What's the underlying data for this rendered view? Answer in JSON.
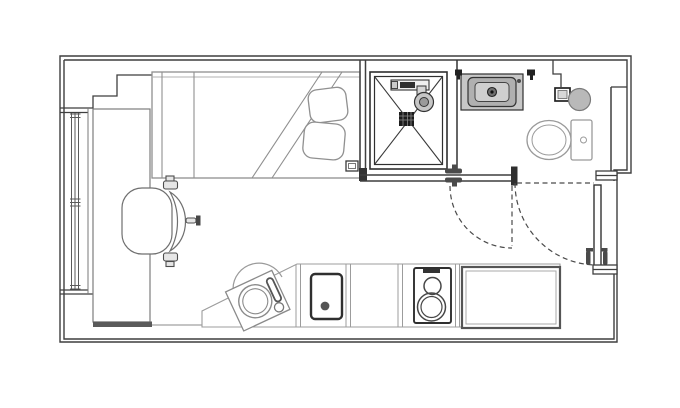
{
  "title": "Studio apartment floor plan",
  "colors": {
    "background": "#ffffff",
    "wall_line": "#3f3f3f",
    "furniture_line": "#8f8f8f",
    "fixture_shade": "#c2c2c2",
    "drain": "#1c1c1c",
    "door_dash": "#4a4a4a"
  },
  "rooms": {
    "main": "Living and sleeping area",
    "bathroom": "Shower room",
    "kitchen": "Kitchenette run"
  },
  "fixtures": {
    "window": "Full-height window in left wall",
    "wall_recess": "Stepped wall recess beside bed",
    "bed": "Single bed with folded duvet",
    "pillow_top": "Pillow",
    "pillow_bottom": "Pillow",
    "socket_box": "Wall-mounted control box at bed foot",
    "desk": "Long desk along window wall",
    "chair": "Swivel desk chair with armrests",
    "shower": "Square shower tray with corner-to-corner fall lines",
    "shower_drain": "Central floor drain",
    "shower_head": "Wall-mounted shower rail and handset",
    "shower_screen": "Shower partition screen",
    "washbasin": "Counter-top washbasin",
    "wall_valve_left": "Wall service point",
    "wall_valve_right": "Wall service point",
    "storage_box": "Wall box in bathroom corner",
    "wall_accessory": "Round wall accessory",
    "toilet": "Close-coupled WC",
    "bathroom_door": "Shower-room door, swing shown dashed",
    "entrance_door": "Entrance door in right wall, swing shown dashed",
    "counter": "Kitchen worktop with angled front",
    "kitchen_sink": "Round inset sink with swivel tap on angled worktop",
    "appliance": "Under-counter appliance with door handle dot",
    "hob": "Two-ring hob unit",
    "worktop_unit": "Boxed worktop / fridge unit"
  }
}
